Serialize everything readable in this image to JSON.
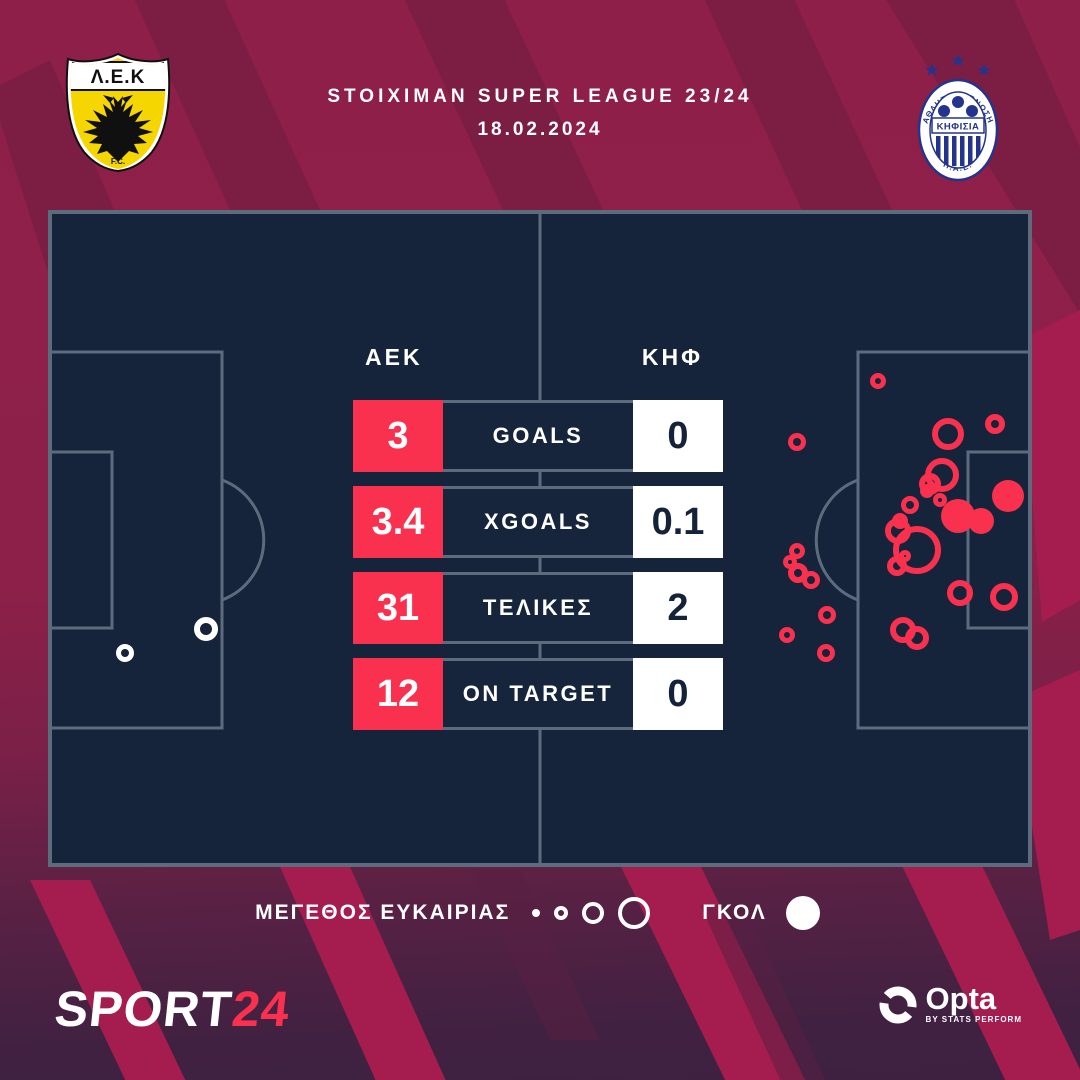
{
  "header": {
    "competition": "STOIXIMAN SUPER LEAGUE 23/24",
    "date": "18.02.2024"
  },
  "teams": {
    "home": {
      "short": "AEK",
      "crest_band": "Λ.Ε.Κ",
      "crest_sub": "F.C."
    },
    "away": {
      "short": "ΚΗΦ",
      "crest_name": "ΚΗΦΙΣΙΑ",
      "crest_top": "ΑΘΛΗΤΙΚΗ ΕΝΩΣΗ",
      "crest_bottom": "Π.Α.Ε."
    }
  },
  "chart_data": [
    {
      "type": "table",
      "title": "Match statistics",
      "categories": [
        "GOALS",
        "XGOALS",
        "ΤΕΛΙΚΕΣ",
        "ON TARGET"
      ],
      "series": [
        {
          "name": "AEK",
          "values": [
            "3",
            "3.4",
            "31",
            "12"
          ]
        },
        {
          "name": "ΚΗΦ",
          "values": [
            "0",
            "0.1",
            "2",
            "0"
          ]
        }
      ]
    },
    {
      "type": "scatter",
      "title": "Shot map (marker size = chance size, filled = goal)",
      "x_range": [
        0,
        984
      ],
      "y_range": [
        0,
        657
      ],
      "series": [
        {
          "name": "AEK",
          "color": "#F9304E",
          "points": [
            {
              "x": 830,
              "y": 171,
              "r": 8,
              "goal": false
            },
            {
              "x": 749,
              "y": 232,
              "r": 9,
              "goal": false
            },
            {
              "x": 900,
              "y": 224,
              "r": 16,
              "goal": false
            },
            {
              "x": 947,
              "y": 214,
              "r": 10,
              "goal": false
            },
            {
              "x": 894,
              "y": 265,
              "r": 17,
              "goal": false
            },
            {
              "x": 882,
              "y": 274,
              "r": 11,
              "goal": false
            },
            {
              "x": 879,
              "y": 281,
              "r": 7,
              "goal": false
            },
            {
              "x": 892,
              "y": 290,
              "r": 7,
              "goal": false
            },
            {
              "x": 910,
              "y": 306,
              "r": 17,
              "goal": true
            },
            {
              "x": 933,
              "y": 311,
              "r": 13,
              "goal": true
            },
            {
              "x": 960,
              "y": 286,
              "r": 16,
              "goal": true
            },
            {
              "x": 862,
              "y": 295,
              "r": 9,
              "goal": false
            },
            {
              "x": 852,
              "y": 311,
              "r": 8,
              "goal": false
            },
            {
              "x": 850,
              "y": 321,
              "r": 13,
              "goal": false
            },
            {
              "x": 869,
              "y": 340,
              "r": 24,
              "goal": false
            },
            {
              "x": 857,
              "y": 346,
              "r": 6,
              "goal": false
            },
            {
              "x": 849,
              "y": 356,
              "r": 10,
              "goal": false
            },
            {
              "x": 912,
              "y": 383,
              "r": 13,
              "goal": false
            },
            {
              "x": 956,
              "y": 387,
              "r": 14,
              "goal": false
            },
            {
              "x": 855,
              "y": 420,
              "r": 13,
              "goal": false
            },
            {
              "x": 869,
              "y": 428,
              "r": 12,
              "goal": false
            },
            {
              "x": 749,
              "y": 341,
              "r": 8,
              "goal": false
            },
            {
              "x": 742,
              "y": 352,
              "r": 7,
              "goal": false
            },
            {
              "x": 750,
              "y": 363,
              "r": 10,
              "goal": false
            },
            {
              "x": 763,
              "y": 370,
              "r": 9,
              "goal": false
            },
            {
              "x": 779,
              "y": 405,
              "r": 9,
              "goal": false
            },
            {
              "x": 739,
              "y": 425,
              "r": 8,
              "goal": false
            },
            {
              "x": 778,
              "y": 443,
              "r": 9,
              "goal": false
            }
          ]
        },
        {
          "name": "ΚΗΦ",
          "color": "#FFFFFF",
          "points": [
            {
              "x": 77,
              "y": 443,
              "r": 9,
              "goal": false
            },
            {
              "x": 158,
              "y": 419,
              "r": 12,
              "goal": false
            }
          ]
        }
      ]
    }
  ],
  "legend": {
    "size_label": "ΜΕΓΕΘΟΣ ΕΥΚΑΙΡΙΑΣ",
    "size_radii": [
      4,
      7,
      11,
      16
    ],
    "goal_label": "ΓΚΟΛ",
    "goal_radius": 17
  },
  "footer": {
    "brand": "SPORT",
    "brand_accent": "24",
    "provider": "Opta",
    "provider_sub": "BY STATS PERFORM"
  },
  "colors": {
    "accent": "#F9304E",
    "pitch": "#15243A",
    "pitch_line": "#5D6C7D",
    "crimson": "#8E1F49",
    "purple": "#3F2141",
    "aek_yellow": "#F6D600",
    "kifisia_blue": "#24338C",
    "white": "#FFFFFF",
    "dark_text": "#14233A"
  }
}
